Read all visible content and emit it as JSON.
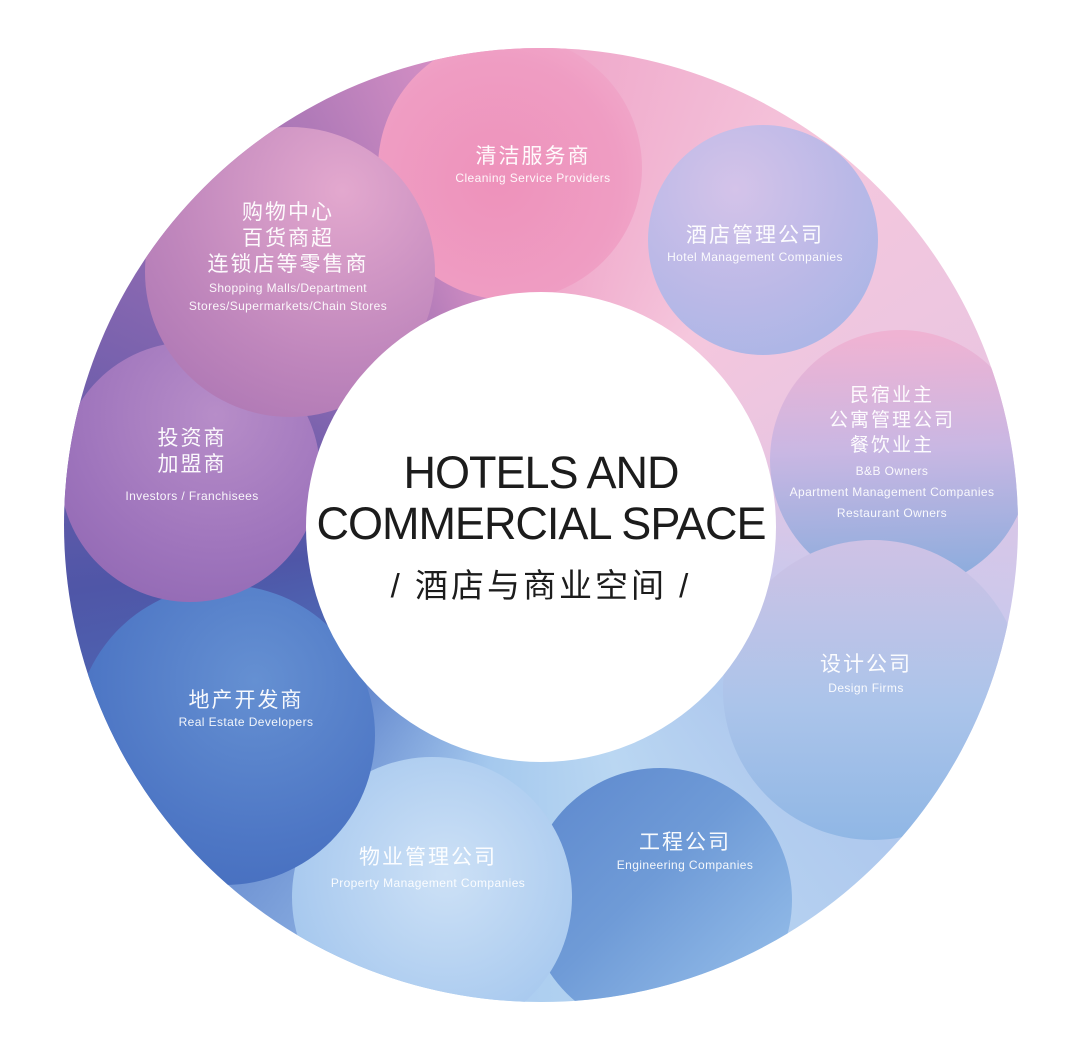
{
  "diagram": {
    "center": {
      "title_line1": "HOTELS AND",
      "title_line2": "COMMERCIAL SPACE",
      "subtitle": "/ 酒店与商业空间 /"
    }
  },
  "segments": [
    {
      "id": "cleaning",
      "zh": [
        "清洁服务商"
      ],
      "en": [
        "Cleaning Service Providers"
      ]
    },
    {
      "id": "hotel-management",
      "zh": [
        "酒店管理公司"
      ],
      "en": [
        "Hotel Management Companies"
      ]
    },
    {
      "id": "bnb",
      "zh": [
        "民宿业主",
        "公寓管理公司",
        "餐饮业主"
      ],
      "en": [
        "B&B Owners",
        "Apartment Management Companies",
        "Restaurant Owners"
      ]
    },
    {
      "id": "design",
      "zh": [
        "设计公司"
      ],
      "en": [
        "Design Firms"
      ]
    },
    {
      "id": "engineering",
      "zh": [
        "工程公司"
      ],
      "en": [
        "Engineering Companies"
      ]
    },
    {
      "id": "property",
      "zh": [
        "物业管理公司"
      ],
      "en": [
        "Property Management Companies"
      ]
    },
    {
      "id": "real-estate",
      "zh": [
        "地产开发商"
      ],
      "en": [
        "Real Estate Developers"
      ]
    },
    {
      "id": "investors",
      "zh": [
        "投资商",
        "加盟商"
      ],
      "en": [
        "Investors / Franchisees"
      ]
    },
    {
      "id": "shopping",
      "zh": [
        "购物中心",
        "百货商超",
        "连锁店等零售商"
      ],
      "en": [
        "Shopping Malls/Department",
        "Stores/Supermarkets/Chain Stores"
      ]
    }
  ],
  "palette": {
    "ring_top_pink": "#efa6c9",
    "ring_right_lavender": "#c9c7ec",
    "ring_bottom_blue": "#a9cdef",
    "ring_left_purple": "#655aa9",
    "bubble_cleaning": "#ee93bc",
    "bubble_hotel_management": "#b3b7e6",
    "bubble_bnb_top": "#efb3d3",
    "bubble_bnb_bottom": "#85abdc",
    "bubble_design": "#abc4ea",
    "bubble_engineering": "#6f9bd7",
    "bubble_property": "#aecdf0",
    "bubble_real_estate": "#4e77c5",
    "bubble_investors": "#9e74bc",
    "bubble_shopping": "#bf86bc",
    "title_color": "#1c1c1c",
    "label_color": "#ffffff"
  }
}
